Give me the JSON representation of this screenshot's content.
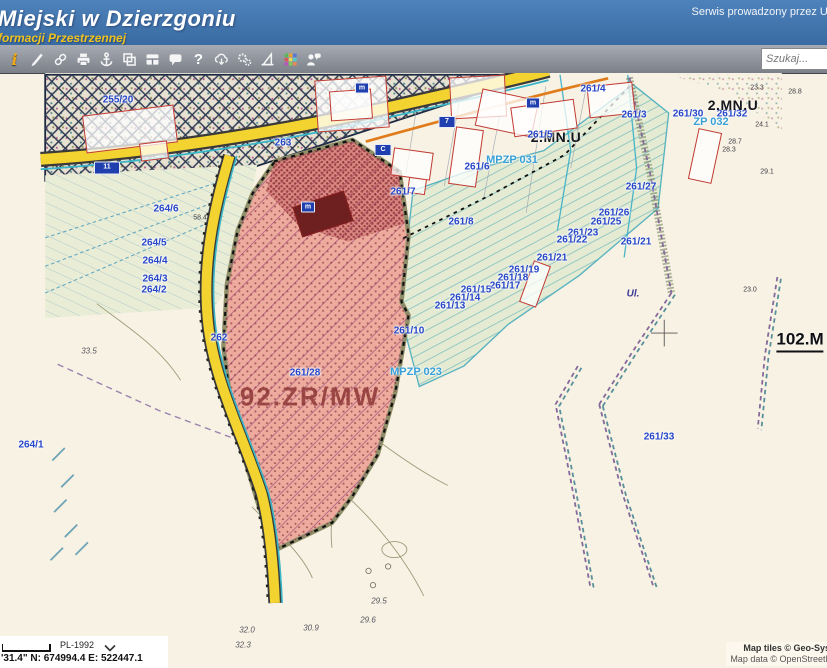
{
  "header": {
    "title": "Miejski w Dzierzgoniu",
    "subtitle": "formacji Przestrzennej",
    "service_note": "Serwis prowadzony przez Urz"
  },
  "toolbar": {
    "search_placeholder": "Szukaj...",
    "icons": [
      "info-icon",
      "pencil-icon",
      "link-icon",
      "print-icon",
      "anchor-icon",
      "copy-icon",
      "layout-panes-icon",
      "speech-bubble-icon",
      "help-icon",
      "cloud-download-icon",
      "settings-gears-icon",
      "compass-icon",
      "legend-palette-icon",
      "feedback-person-icon"
    ]
  },
  "statusbar": {
    "crs": "PL-1992",
    "coords": "'31.4\"  N: 674994.4  E: 522447.1"
  },
  "attribution": {
    "tiles": "Map tiles © Geo-Syst",
    "data": "Map data © OpenStreetM"
  },
  "colors": {
    "header_blue": "#4e82ba",
    "gold": "#f0c31c",
    "road_yellow": "#f3d32f",
    "zone_pink": "#ecab9d",
    "zone_text": "#8e3636",
    "parcel_blue": "#2646c8",
    "mpzp_cyan": "#38a0d8"
  },
  "map": {
    "zone_label": "92.ZR/MW",
    "labels": [
      {
        "t": "255/20",
        "c": "blue",
        "x": 118,
        "y": 100
      },
      {
        "t": "263",
        "c": "blue",
        "x": 283,
        "y": 143
      },
      {
        "t": "261/4",
        "c": "blue",
        "x": 593,
        "y": 89
      },
      {
        "t": "261/3",
        "c": "blue",
        "x": 634,
        "y": 115
      },
      {
        "t": "261/30",
        "c": "blue",
        "x": 688,
        "y": 114
      },
      {
        "t": "261/32",
        "c": "blue",
        "x": 732,
        "y": 114
      },
      {
        "t": "ZP 032",
        "c": "cyan",
        "x": 711,
        "y": 122
      },
      {
        "t": "2.MN.U",
        "c": "black",
        "x": 733,
        "y": 105
      },
      {
        "t": "2.MN.U",
        "c": "black",
        "x": 556,
        "y": 137
      },
      {
        "t": "261/5",
        "c": "blue",
        "x": 540,
        "y": 135
      },
      {
        "t": "MPZP 031",
        "c": "cyan",
        "x": 512,
        "y": 160
      },
      {
        "t": "261/6",
        "c": "blue",
        "x": 477,
        "y": 167
      },
      {
        "t": "261/7",
        "c": "blue",
        "x": 403,
        "y": 192
      },
      {
        "t": "261/8",
        "c": "blue",
        "x": 461,
        "y": 222
      },
      {
        "t": "261/27",
        "c": "blue",
        "x": 641,
        "y": 187
      },
      {
        "t": "261/26",
        "c": "blue",
        "x": 614,
        "y": 213
      },
      {
        "t": "261/25",
        "c": "blue",
        "x": 606,
        "y": 222
      },
      {
        "t": "261/23",
        "c": "blue",
        "x": 583,
        "y": 233
      },
      {
        "t": "261/22",
        "c": "blue",
        "x": 572,
        "y": 240
      },
      {
        "t": "261/21",
        "c": "blue",
        "x": 636,
        "y": 242
      },
      {
        "t": "261/21",
        "c": "blue",
        "x": 552,
        "y": 258
      },
      {
        "t": "261/19",
        "c": "blue",
        "x": 524,
        "y": 270
      },
      {
        "t": "261/18",
        "c": "blue",
        "x": 513,
        "y": 278
      },
      {
        "t": "261/17",
        "c": "blue",
        "x": 505,
        "y": 286
      },
      {
        "t": "261/15",
        "c": "blue",
        "x": 476,
        "y": 290
      },
      {
        "t": "261/14",
        "c": "blue",
        "x": 465,
        "y": 298
      },
      {
        "t": "261/13",
        "c": "blue",
        "x": 450,
        "y": 306
      },
      {
        "t": "261/10",
        "c": "blue",
        "x": 409,
        "y": 331
      },
      {
        "t": "261/28",
        "c": "blue",
        "x": 305,
        "y": 373
      },
      {
        "t": "MPZP 023",
        "c": "cyan",
        "x": 416,
        "y": 372
      },
      {
        "t": "92.ZR/MW",
        "c": "zone",
        "x": 310,
        "y": 397
      },
      {
        "t": "264/6",
        "c": "blue",
        "x": 166,
        "y": 209
      },
      {
        "t": "264/5",
        "c": "blue",
        "x": 154,
        "y": 243
      },
      {
        "t": "264/4",
        "c": "blue",
        "x": 155,
        "y": 261
      },
      {
        "t": "264/3",
        "c": "blue",
        "x": 155,
        "y": 279
      },
      {
        "t": "264/2",
        "c": "blue",
        "x": 154,
        "y": 290
      },
      {
        "t": "264/1",
        "c": "blue",
        "x": 31,
        "y": 445
      },
      {
        "t": "262",
        "c": "blue",
        "x": 219,
        "y": 338
      },
      {
        "t": "261/33",
        "c": "blue",
        "x": 659,
        "y": 437
      },
      {
        "t": "102.M",
        "c": "big",
        "x": 800,
        "y": 341
      },
      {
        "t": "Ul.",
        "c": "blueital",
        "x": 633,
        "y": 294
      },
      {
        "t": "33.5",
        "c": "measital",
        "x": 89,
        "y": 351
      },
      {
        "t": "28.8",
        "c": "meas",
        "x": 795,
        "y": 92
      },
      {
        "t": "23.3",
        "c": "meas",
        "x": 757,
        "y": 88
      },
      {
        "t": "24.1",
        "c": "meas",
        "x": 762,
        "y": 125
      },
      {
        "t": "28.7",
        "c": "meas",
        "x": 735,
        "y": 142
      },
      {
        "t": "28.3",
        "c": "meas",
        "x": 729,
        "y": 150
      },
      {
        "t": "29.1",
        "c": "meas",
        "x": 767,
        "y": 172
      },
      {
        "t": "23.0",
        "c": "meas",
        "x": 750,
        "y": 290
      },
      {
        "t": "58.4",
        "c": "meas",
        "x": 200,
        "y": 218
      },
      {
        "t": "29.5",
        "c": "measital",
        "x": 379,
        "y": 601
      },
      {
        "t": "29.6",
        "c": "measital",
        "x": 368,
        "y": 620
      },
      {
        "t": "30.9",
        "c": "measital",
        "x": 311,
        "y": 628
      },
      {
        "t": "32.0",
        "c": "measital",
        "x": 247,
        "y": 630
      },
      {
        "t": "32.3",
        "c": "measital",
        "x": 243,
        "y": 645
      }
    ],
    "shields": [
      {
        "t": "11",
        "x": 107,
        "y": 168,
        "w": 24,
        "h": 11
      },
      {
        "t": "7",
        "x": 447,
        "y": 122,
        "w": 15,
        "h": 10
      },
      {
        "t": "C",
        "x": 383,
        "y": 150,
        "w": 15,
        "h": 10
      },
      {
        "t": "m",
        "x": 533,
        "y": 103,
        "w": 12,
        "h": 9
      },
      {
        "t": "m",
        "x": 362,
        "y": 88,
        "w": 12,
        "h": 9
      },
      {
        "t": "m",
        "x": 308,
        "y": 207,
        "w": 12,
        "h": 9
      }
    ],
    "buildings": [
      {
        "x": 84,
        "y": 110,
        "w": 90,
        "h": 36,
        "r": -7
      },
      {
        "x": 140,
        "y": 142,
        "w": 26,
        "h": 16,
        "r": -7
      },
      {
        "x": 316,
        "y": 78,
        "w": 70,
        "h": 50,
        "r": -4
      },
      {
        "x": 330,
        "y": 90,
        "w": 40,
        "h": 28,
        "r": -4
      },
      {
        "x": 450,
        "y": 76,
        "w": 54,
        "h": 40,
        "r": -3
      },
      {
        "x": 478,
        "y": 94,
        "w": 56,
        "h": 36,
        "r": 12
      },
      {
        "x": 452,
        "y": 128,
        "w": 26,
        "h": 56,
        "r": 8
      },
      {
        "x": 392,
        "y": 150,
        "w": 38,
        "h": 26,
        "r": 8
      },
      {
        "x": 408,
        "y": 178,
        "w": 16,
        "h": 14,
        "r": 8
      },
      {
        "x": 512,
        "y": 103,
        "w": 62,
        "h": 28,
        "r": -8
      },
      {
        "x": 588,
        "y": 84,
        "w": 44,
        "h": 30,
        "r": -6
      },
      {
        "x": 693,
        "y": 130,
        "w": 22,
        "h": 50,
        "r": 12
      },
      {
        "x": 526,
        "y": 262,
        "w": 16,
        "h": 42,
        "r": 20
      },
      {
        "x": 296,
        "y": 198,
        "w": 52,
        "h": 30,
        "r": -18,
        "dark": true
      }
    ]
  }
}
